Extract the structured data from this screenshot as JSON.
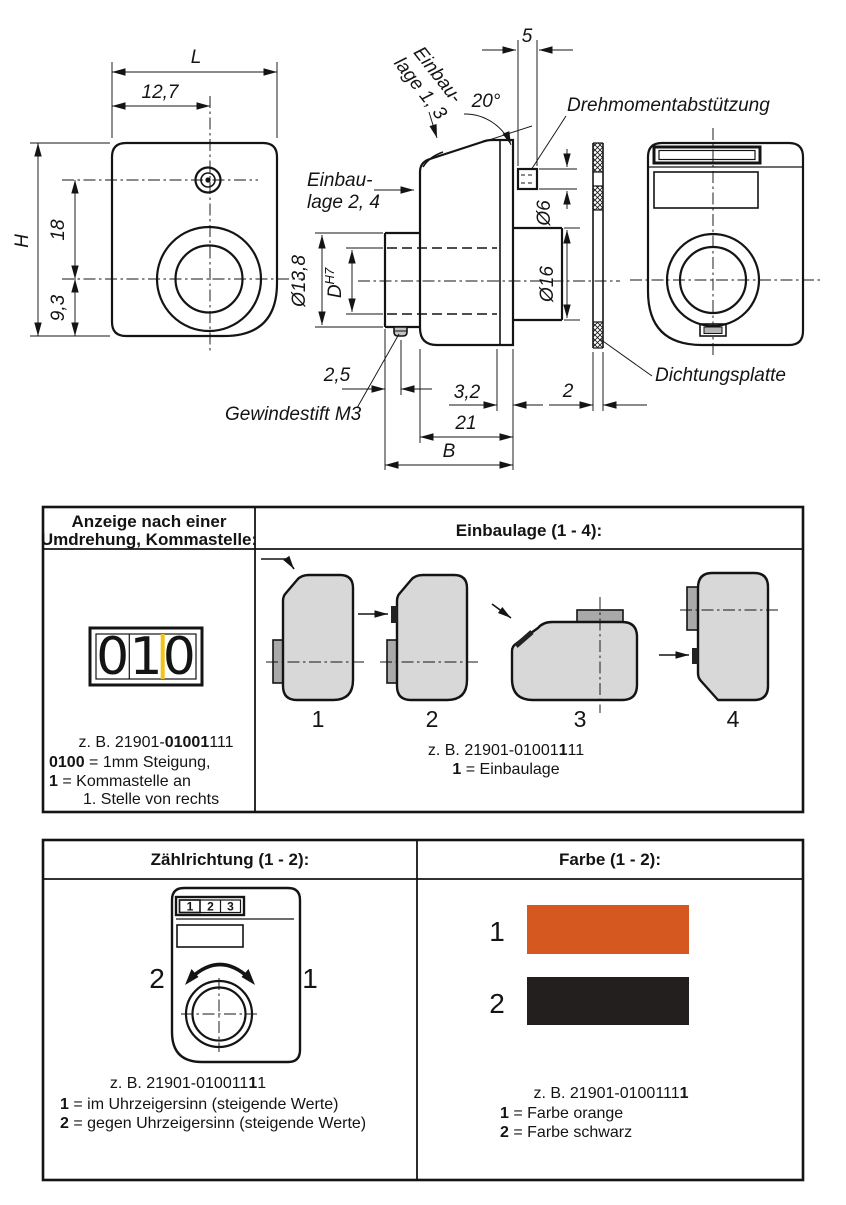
{
  "colors": {
    "marker_yellow": "#f0c419",
    "body_gray": "#d8d8d8",
    "tab_gray": "#a9a9a9",
    "swatch_orange": "#d4581f",
    "swatch_black": "#241f1f"
  },
  "drawing": {
    "front_view": {
      "dim_L": "L",
      "dim_127": "12,7",
      "dim_H": "H",
      "dim_18": "18",
      "dim_93": "9,3"
    },
    "side_view": {
      "label_einbaulage13_l1": "Einbau-",
      "label_einbaulage13_l2": "lage 1, 3",
      "label_einbaulage24_l1": "Einbau-",
      "label_einbaulage24_l2": "lage 2, 4",
      "dim_20deg": "20°",
      "dim_5": "5",
      "label_drehmoment": "Drehmomentabstützung",
      "dim_dia6": "Ø6",
      "dim_dia16": "Ø16",
      "dim_dia138": "Ø13,8",
      "dim_D": "D",
      "dim_D_tol": "H7",
      "dim_25": "2,5",
      "label_gewindestift": "Gewindestift M3",
      "dim_32": "3,2",
      "dim_21": "21",
      "dim_B": "B"
    },
    "plate_view": {
      "dim_2": "2",
      "label_dichtungsplatte": "Dichtungsplatte"
    }
  },
  "table1": {
    "header_left_l1": "Anzeige nach einer",
    "header_left_l2": "Umdrehung, Kommastelle:",
    "header_right": "Einbaulage (1 - 4):",
    "counter": {
      "digits": [
        "0",
        "1",
        "0"
      ]
    },
    "example_left": {
      "prefix": "z. B. 21901-",
      "bold": "01001",
      "suffix": "111"
    },
    "legend_left": [
      {
        "bold": "0100",
        "text": " = 1mm Steigung,"
      },
      {
        "bold": "1",
        "text": " = Kommastelle an"
      },
      {
        "bold": "",
        "text": "1. Stelle von rechts"
      }
    ],
    "positions": [
      "1",
      "2",
      "3",
      "4"
    ],
    "example_right": {
      "prefix": "z. B. 21901-01001",
      "bold": "1",
      "suffix": "11"
    },
    "legend_right": {
      "bold": "1",
      "text": " = Einbaulage"
    }
  },
  "table2": {
    "header_left": "Zählrichtung (1 - 2):",
    "header_right": "Farbe (1 - 2):",
    "mini_counter": {
      "digits": [
        "1",
        "2",
        "3"
      ]
    },
    "direction_labels": {
      "left": "2",
      "right": "1"
    },
    "example_left": {
      "prefix": "z. B. 21901-010011",
      "bold": "1",
      "suffix": "1"
    },
    "legend_left": [
      {
        "bold": "1",
        "text": " = im Uhrzeigersinn (steigende Werte)"
      },
      {
        "bold": "2",
        "text": " = gegen Uhrzeigersinn (steigende Werte)"
      }
    ],
    "swatches": [
      {
        "label": "1",
        "color": "#d4581f",
        "name": "orange"
      },
      {
        "label": "2",
        "color": "#241f1f",
        "name": "schwarz"
      }
    ],
    "example_right": {
      "prefix": "z. B. 21901-0100111",
      "bold": "1",
      "suffix": ""
    },
    "legend_right": [
      {
        "bold": "1",
        "text": " = Farbe orange"
      },
      {
        "bold": "2",
        "text": " = Farbe schwarz"
      }
    ]
  }
}
